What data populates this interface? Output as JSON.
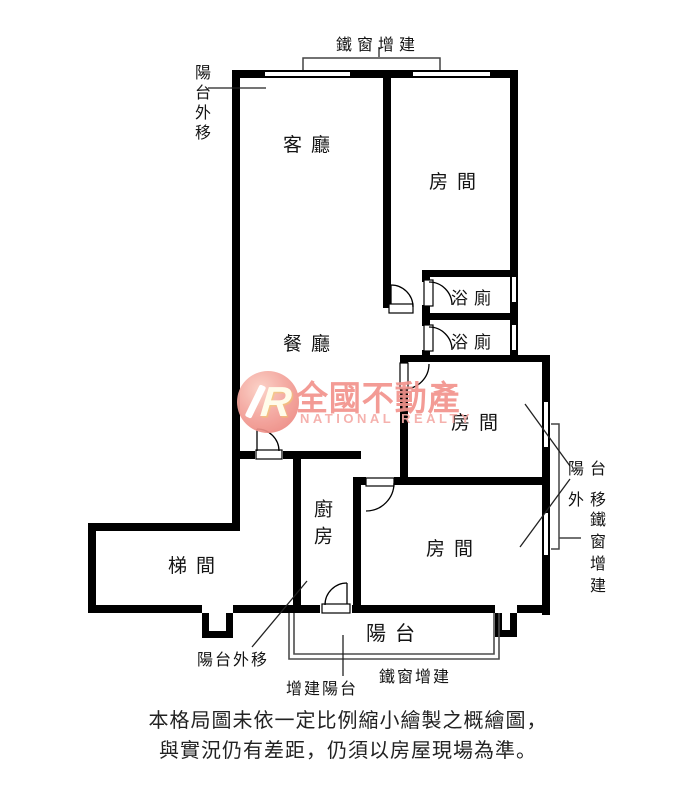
{
  "floorplan": {
    "rooms": {
      "living": "客廳",
      "bedroom_top": "房間",
      "bathroom_upper": "浴廁",
      "bathroom_lower": "浴廁",
      "dining": "餐廳",
      "bedroom_middle": "房間",
      "bedroom_bottom": "房間",
      "kitchen": "廚房",
      "stairwell": "梯間",
      "balcony": "陽台"
    },
    "annotations": {
      "top_iron_window": "鐵窗增建",
      "left_balcony_moved": "陽台外移",
      "right_balcony_moved_line1": "陽台",
      "right_balcony_moved_line2": "外移",
      "right_iron_window": "鐵窗增建",
      "bottom_balcony_moved": "陽台外移",
      "bottom_added_balcony": "增建陽台",
      "bottom_iron_window": "鐵窗增建"
    },
    "logo": {
      "monogram": "R",
      "brand": "全國不動產",
      "tagline": "NATIONAL REALTY"
    },
    "disclaimer": {
      "line1": "本格局圖未依一定比例縮小繪製之概繪圖，",
      "line2": "與實況仍有差距，仍須以房屋現場為準。"
    },
    "colors": {
      "wall": "#000000",
      "line": "#3a3a3a",
      "logo_text": "#f2938d",
      "logo_tagline": "#f5aba7",
      "logo_circle": "#ee8e86"
    }
  }
}
